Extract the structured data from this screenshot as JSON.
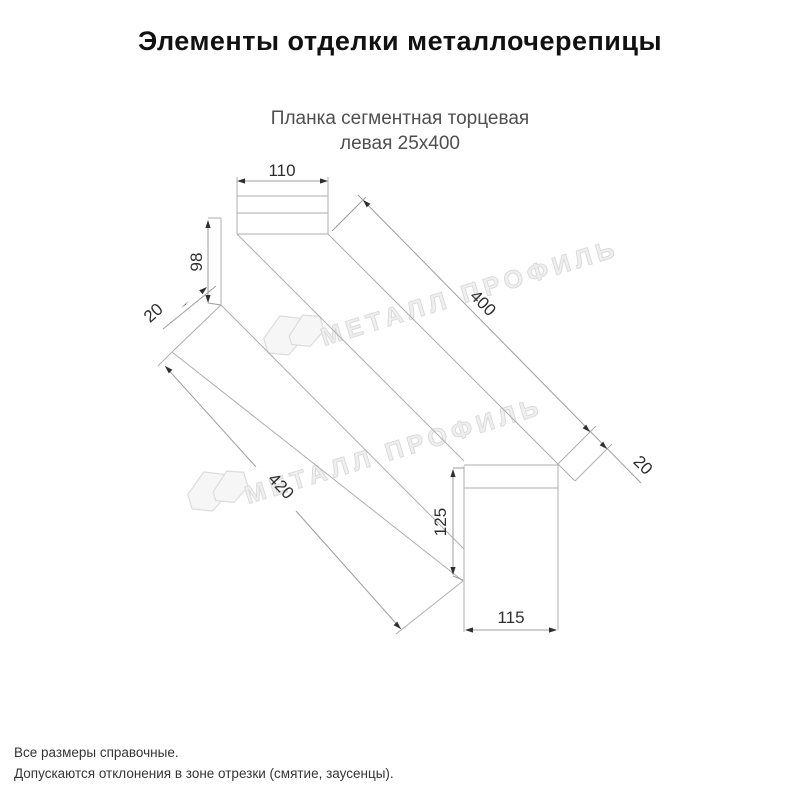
{
  "title": "Элементы отделки металлочерепицы",
  "subtitle": {
    "line1": "Планка сегментная торцевая",
    "line2": "левая 25х400"
  },
  "drawing": {
    "watermark_text": "МЕТАЛЛ ПРОФИЛЬ",
    "dimensions": {
      "top_tab_width": "110",
      "left_edge_height": "98",
      "left_hem": "20",
      "top_length": "400",
      "right_hem": "20",
      "bottom_length": "420",
      "end_face_height": "125",
      "end_face_width": "115"
    }
  },
  "footnotes": {
    "line1": "Все размеры справочные.",
    "line2": "Допускаются отклонения в зоне отрезки (смятие, заусенцы)."
  }
}
